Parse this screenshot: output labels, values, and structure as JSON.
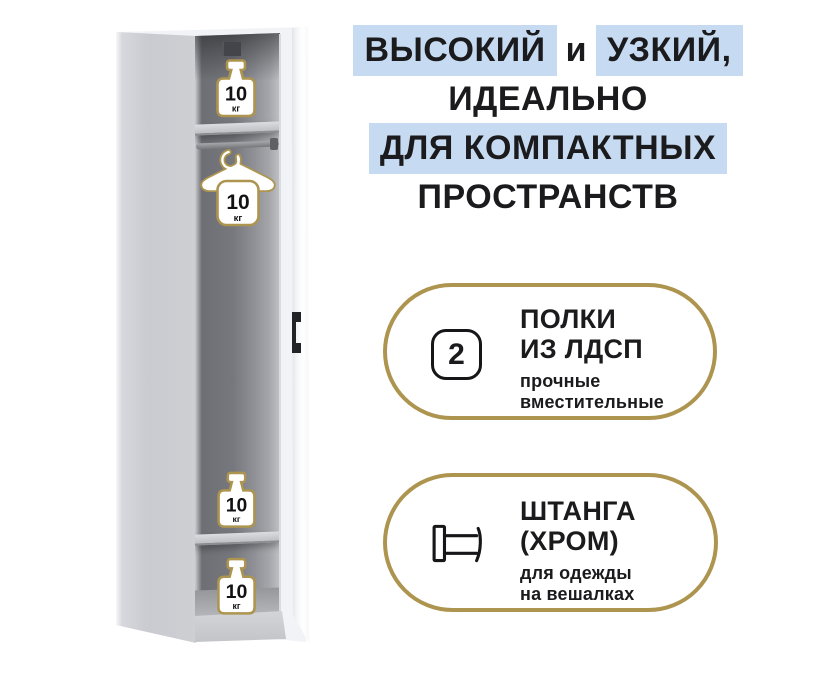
{
  "product_card": {
    "headline": {
      "line1_part1": "ВЫСОКИЙ",
      "line1_part2": "и",
      "line1_part3": "УЗКИЙ,",
      "line2": "ИДЕАЛЬНО",
      "line3": "ДЛЯ КОМПАКТНЫХ",
      "line4": "ПРОСТРАНСТВ",
      "highlight_color": "#c6dbf1",
      "text_color": "#1b1b1d"
    },
    "wardrobe": {
      "shelf_load_value": "10",
      "shelf_load_unit": "кг"
    },
    "features": [
      {
        "badge_count": "2",
        "title_line1": "ПОЛКИ",
        "title_line2": "ИЗ ЛДСП",
        "subtitle_line1": "прочные",
        "subtitle_line2": "вместительные",
        "icon": "shelf-count-box"
      },
      {
        "title_line1": "ШТАНГА",
        "title_line2": "(ХРОМ)",
        "subtitle_line1": "для одежды",
        "subtitle_line2": "на вешалках",
        "icon": "clothes-rail-icon"
      }
    ],
    "accent_gold": "#ad9550"
  }
}
